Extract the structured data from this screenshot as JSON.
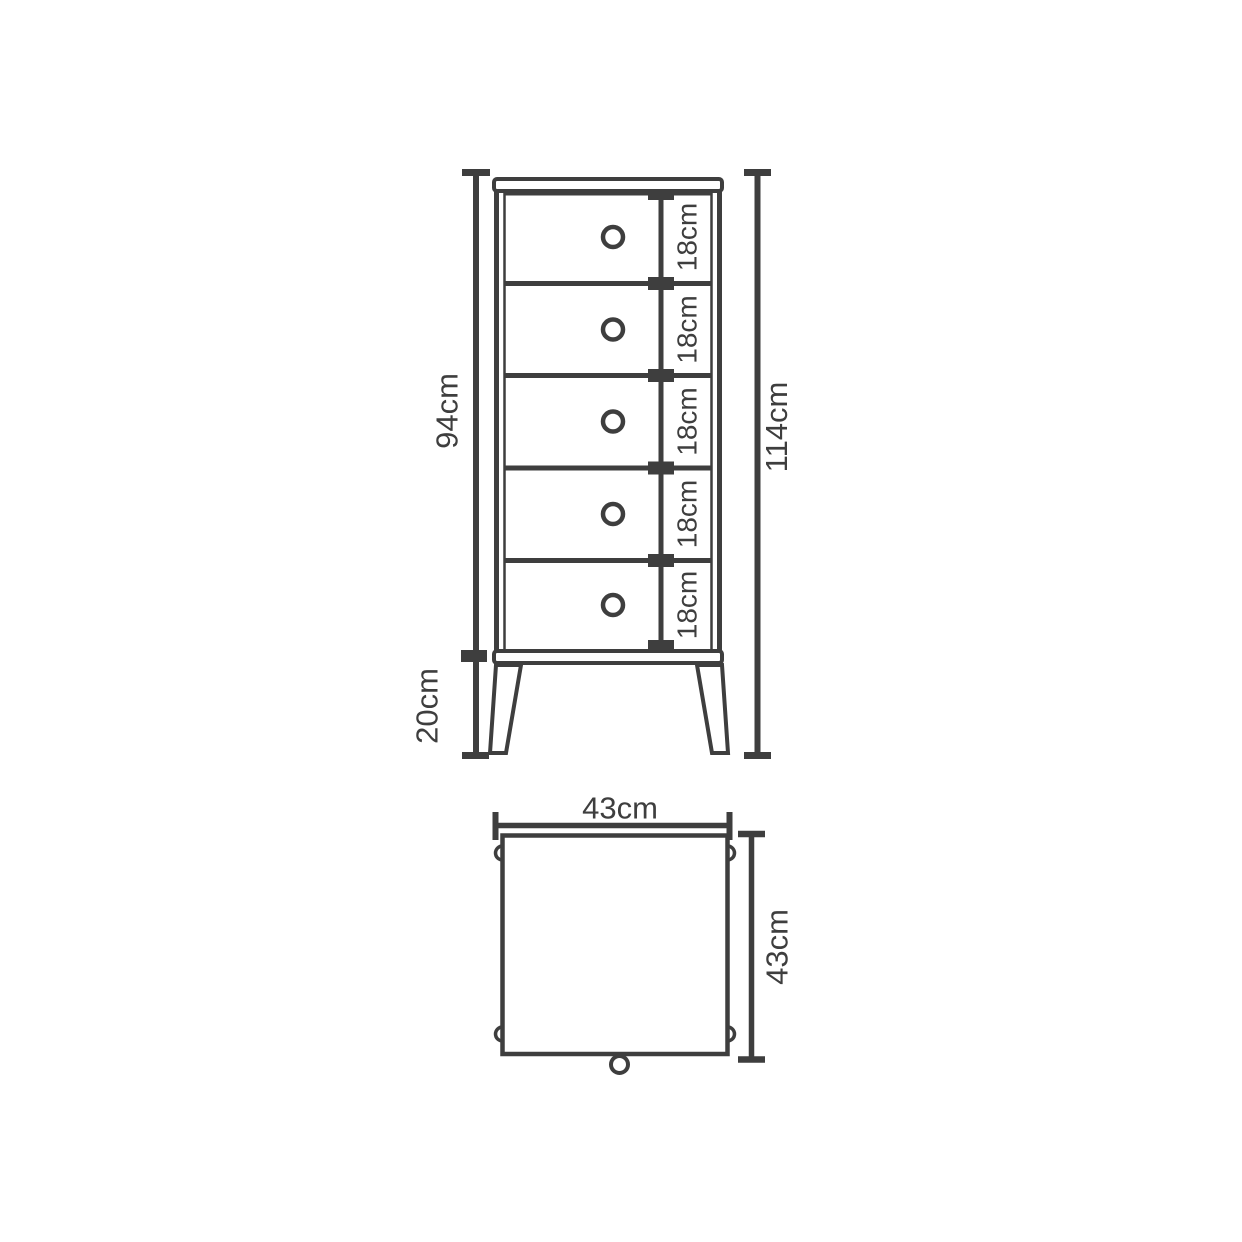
{
  "colors": {
    "line": "#3e3e3e",
    "background": "#ffffff"
  },
  "front_view": {
    "body_height_label": "94cm",
    "leg_height_label": "20cm",
    "total_height_label": "114cm",
    "drawers": [
      {
        "height_label": "18cm"
      },
      {
        "height_label": "18cm"
      },
      {
        "height_label": "18cm"
      },
      {
        "height_label": "18cm"
      },
      {
        "height_label": "18cm"
      }
    ]
  },
  "top_view": {
    "width_label": "43cm",
    "depth_label": "43cm"
  }
}
